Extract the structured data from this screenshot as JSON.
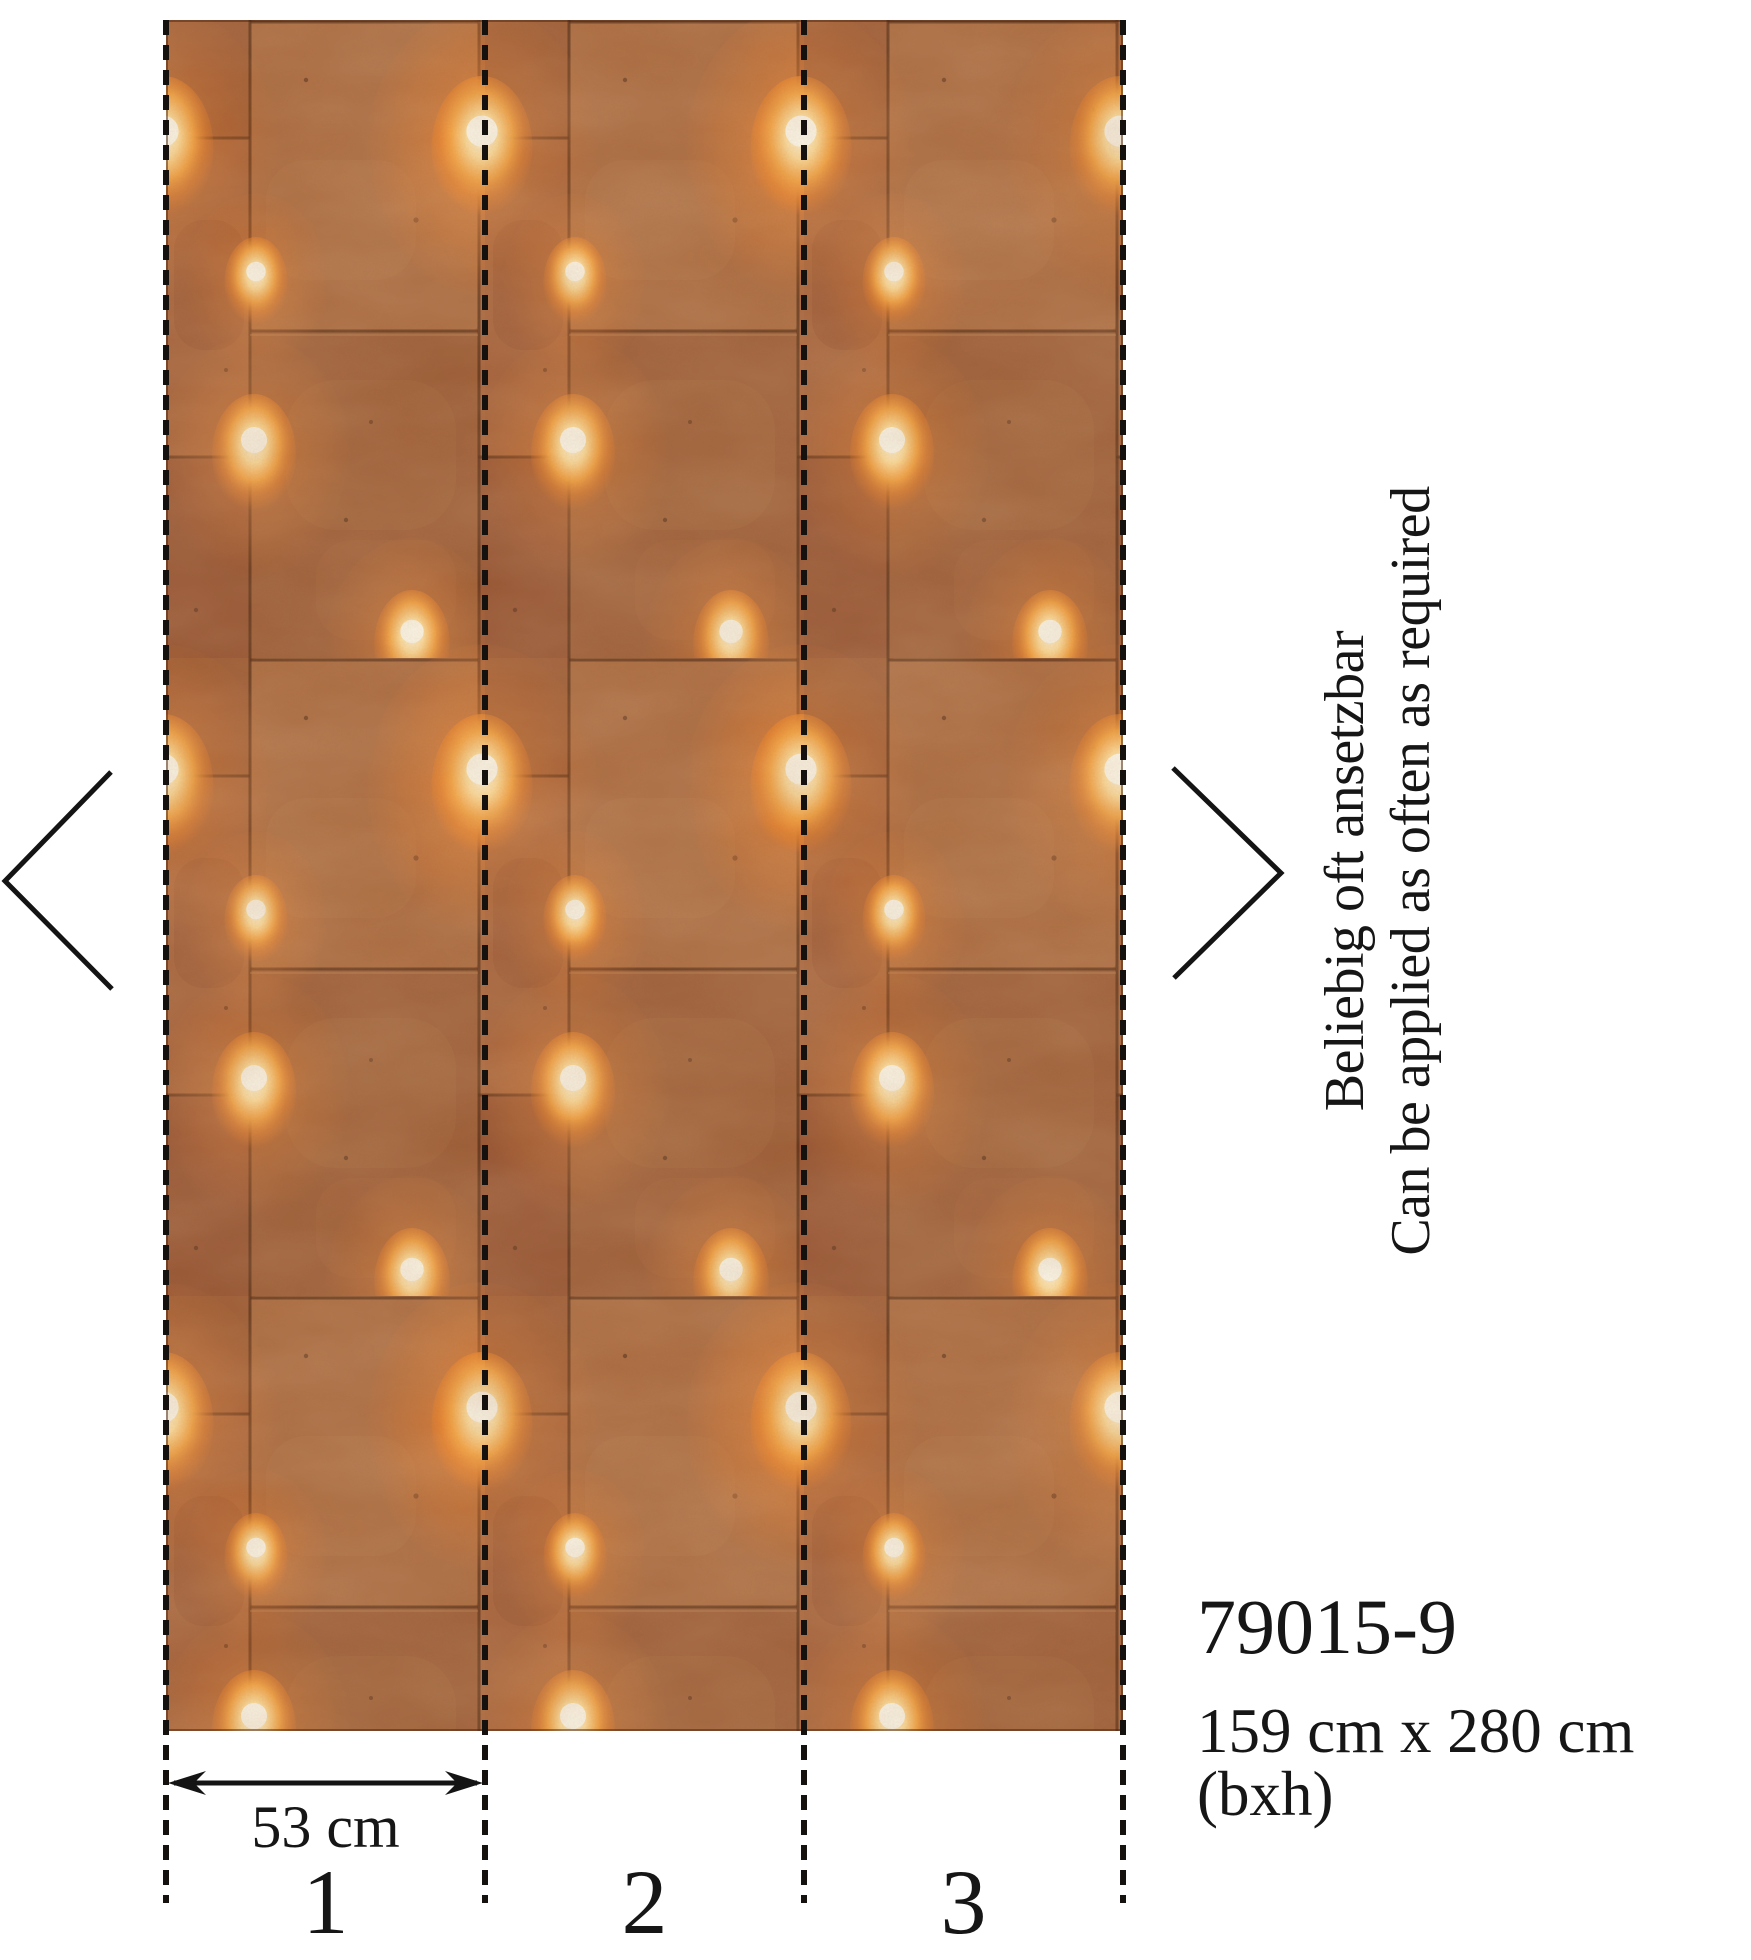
{
  "product": {
    "code": "79015-9",
    "size_label": "159 cm x 280 cm (bxh)"
  },
  "repeat_note": {
    "line_de": "Beliebig oft ansetzbar",
    "line_en": "Can be applied as often as required"
  },
  "measurement": {
    "strip_width_label": "53 cm"
  },
  "panels": [
    {
      "label": "1"
    },
    {
      "label": "2"
    },
    {
      "label": "3"
    }
  ],
  "nav": {
    "prev_icon": "chevron-left",
    "next_icon": "chevron-right"
  },
  "wallpaper_swatch": {
    "base_color": "#a05c33",
    "block_light": "#ab6a40",
    "block_dark": "#935231",
    "seam_color": "#4f2712",
    "glow_outer": "#ee8d33",
    "glow_core": "#fff7e2",
    "ink_color": "#161616"
  }
}
